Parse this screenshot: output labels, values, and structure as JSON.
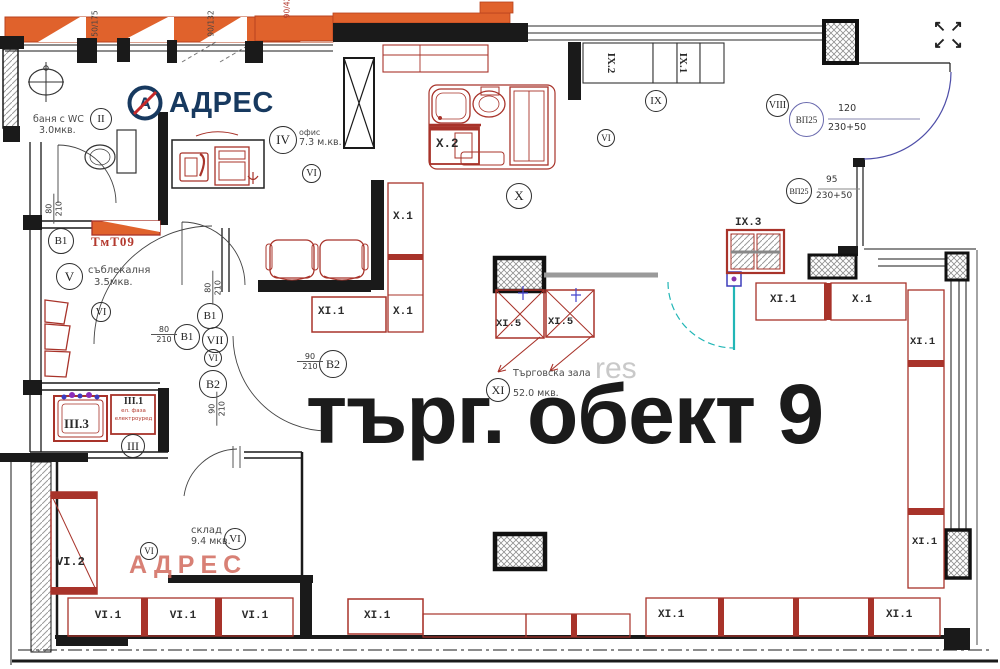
{
  "logo": {
    "brand": "АДРЕС"
  },
  "watermarks": {
    "red": "АДРЕС",
    "faint": "res"
  },
  "title": "търг. обект 9",
  "rooms": {
    "bath": {
      "marker": "II",
      "name": "баня с WC",
      "area": "3.0мкв."
    },
    "office": {
      "marker": "IV",
      "name": "офис",
      "area": "7.3 м.кв."
    },
    "dressing": {
      "marker": "V",
      "name": "съблекалня",
      "area": "3.5мкв."
    },
    "storage": {
      "marker": "VI",
      "name": "склад",
      "area": "9.4 мкв."
    },
    "hall": {
      "marker": "XI",
      "name": "Търговска зала",
      "area": "52.0 мкв."
    }
  },
  "markers": {
    "ii": "II",
    "iii": "III",
    "iv": "IV",
    "v": "V",
    "vi": "VI",
    "vii": "VII",
    "viii": "VIII",
    "ix": "IX",
    "x": "X",
    "xi": "XI",
    "b1": "B1",
    "b2": "B2",
    "vp25": "ВП25"
  },
  "dims": {
    "d80": {
      "w": "80",
      "h": "210"
    },
    "d90": {
      "w": "90",
      "h": "210"
    },
    "vp1": {
      "w": "120",
      "h": "230+50"
    },
    "vp2": {
      "w": "95",
      "h": "230+50"
    },
    "win1": "50/175",
    "win2": "90/132",
    "win3": "90/42"
  },
  "units": {
    "tmt": "ТмТ09",
    "iii1": {
      "label": "III.1",
      "note1": "ел. фаза",
      "note2": "електроуред"
    },
    "iii3": "III.3",
    "x1": "X.1",
    "x2": "X.2",
    "xi1": "XI.1",
    "xi5": "XI.5",
    "ix1": "IX.1",
    "ix2": "IX.2",
    "ix3": "IX.3",
    "vi1": "VI.1",
    "vi2": "VI.2"
  },
  "icons": {
    "nw": "↖",
    "ne": "↗",
    "sw": "↙",
    "se": "↘"
  }
}
